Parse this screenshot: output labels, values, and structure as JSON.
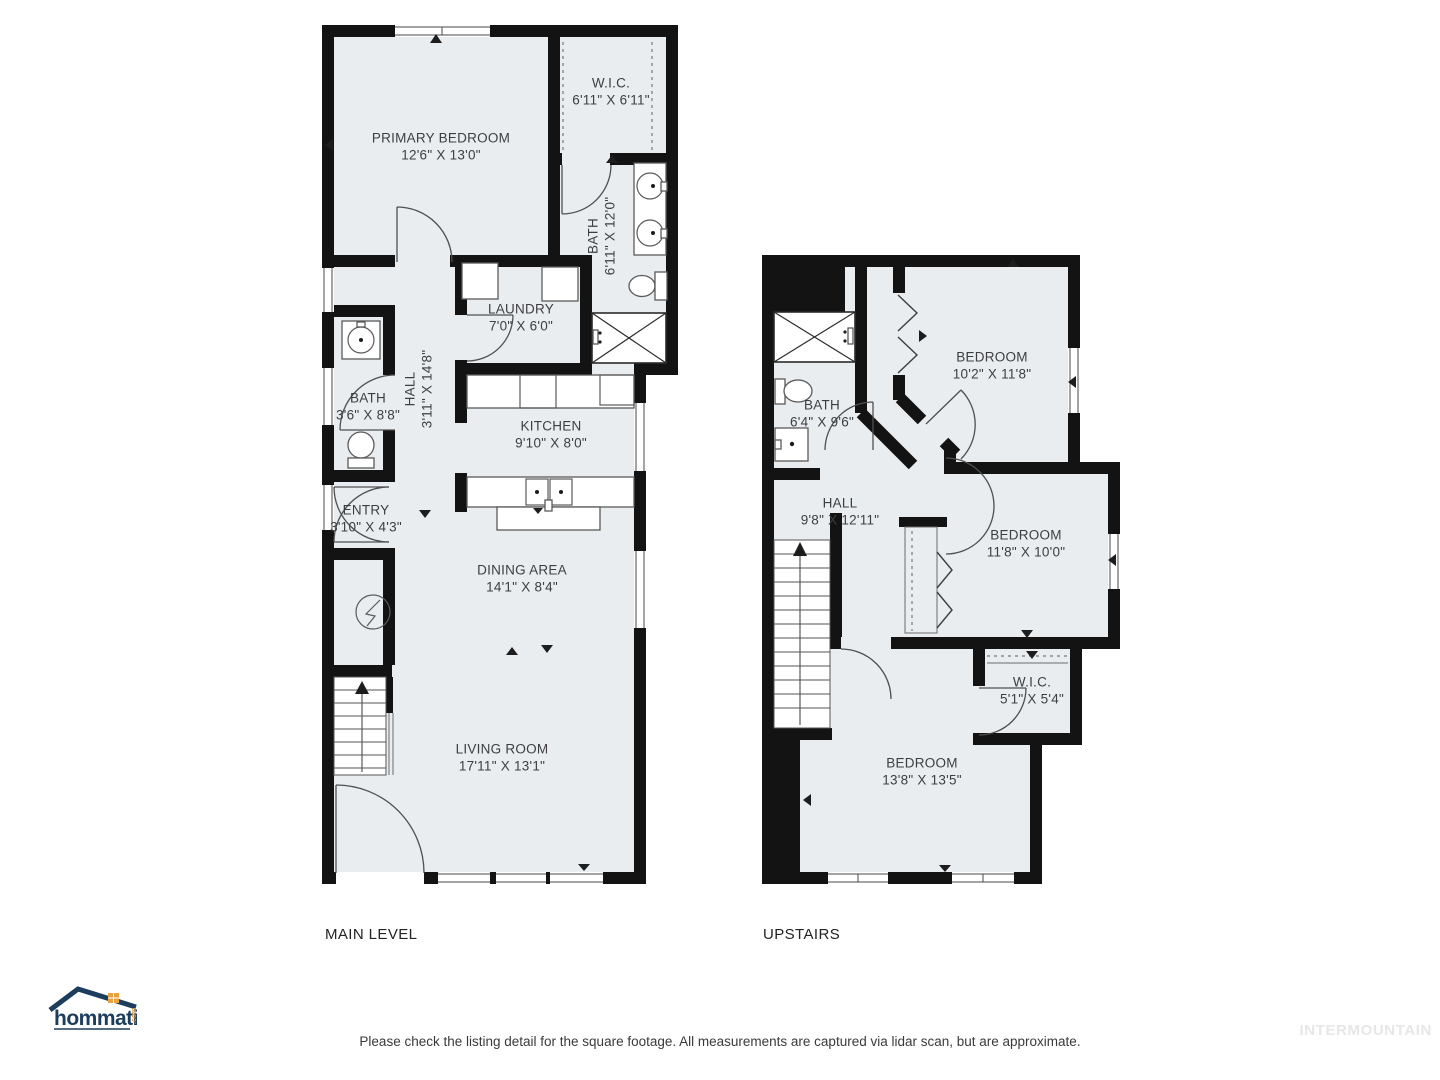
{
  "plans": [
    {
      "id": "main-level",
      "title": "MAIN LEVEL",
      "rooms": [
        {
          "name": "PRIMARY BEDROOM",
          "dims": "12'6\" X 13'0\""
        },
        {
          "name": "W.I.C.",
          "dims": "6'11\" X 6'11\""
        },
        {
          "name": "BATH",
          "dims": "6'11\" X 12'0\""
        },
        {
          "name": "LAUNDRY",
          "dims": "7'0\" X 6'0\""
        },
        {
          "name": "HALL",
          "dims": "3'11\" X 14'8\""
        },
        {
          "name": "KITCHEN",
          "dims": "9'10\" X 8'0\""
        },
        {
          "name": "BATH",
          "dims": "3'6\" X 8'8\""
        },
        {
          "name": "ENTRY",
          "dims": "3'10\" X 4'3\""
        },
        {
          "name": "DINING AREA",
          "dims": "14'1\" X 8'4\""
        },
        {
          "name": "LIVING ROOM",
          "dims": "17'11\" X 13'1\""
        }
      ]
    },
    {
      "id": "upstairs",
      "title": "UPSTAIRS",
      "rooms": [
        {
          "name": "BEDROOM",
          "dims": "10'2\" X 11'8\""
        },
        {
          "name": "BATH",
          "dims": "6'4\" X 9'6\""
        },
        {
          "name": "HALL",
          "dims": "9'8\" X 12'11\""
        },
        {
          "name": "BEDROOM",
          "dims": "11'8\" X 10'0\""
        },
        {
          "name": "W.I.C.",
          "dims": "5'1\" X 5'4\""
        },
        {
          "name": "BEDROOM",
          "dims": "13'8\" X 13'5\""
        }
      ]
    }
  ],
  "branding": {
    "logo_text": "hommati",
    "logo_suffix": ".com",
    "watermark": "INTERMOUNTAIN",
    "logo_navy": "#1d3d5c",
    "logo_orange": "#e8a33d"
  },
  "footer": {
    "disclaimer": "Please check the listing detail for the square footage. All measurements are captured via lidar scan, but are approximate."
  },
  "colors": {
    "floor": "#e9edf0",
    "wall": "#131313",
    "label_text": "#3e3e41"
  },
  "icons": {
    "furnace": "lightning-circle",
    "sink": "basin-circle",
    "toilet": "toilet-shape",
    "shower": "x-box",
    "bathtub": "x-box",
    "stairs": "treads-with-up-arrow",
    "closet_rod": "dashed-line",
    "bifold_door": "chevron"
  }
}
